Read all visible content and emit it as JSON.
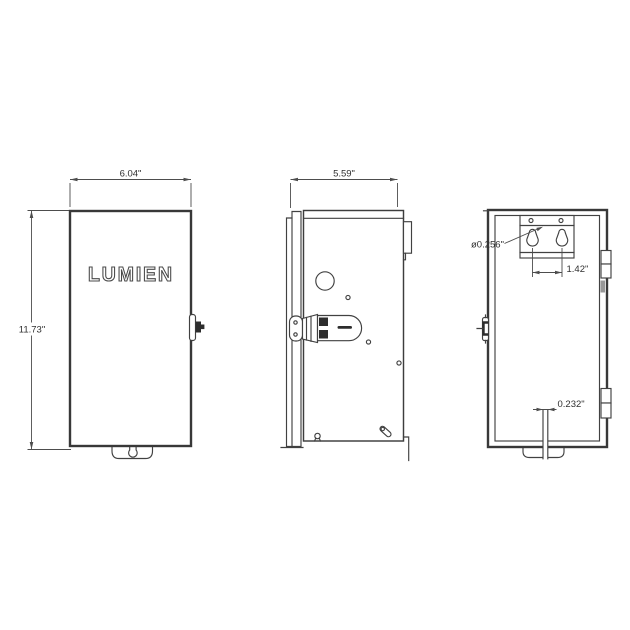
{
  "views": {
    "front": {
      "brand": "LUMIEN",
      "dims": {
        "width": "6.04\"",
        "height": "11.73\""
      }
    },
    "side": {
      "dims": {
        "depth": "5.59\""
      }
    },
    "back": {
      "dims": {
        "keyhole_diameter": "ø0.256\"",
        "keyhole_spacing": "1.42\"",
        "slot_width": "0.232\""
      }
    }
  },
  "colors": {
    "line": "#414141",
    "dimension": "#4d4d4d",
    "background": "#ffffff"
  }
}
